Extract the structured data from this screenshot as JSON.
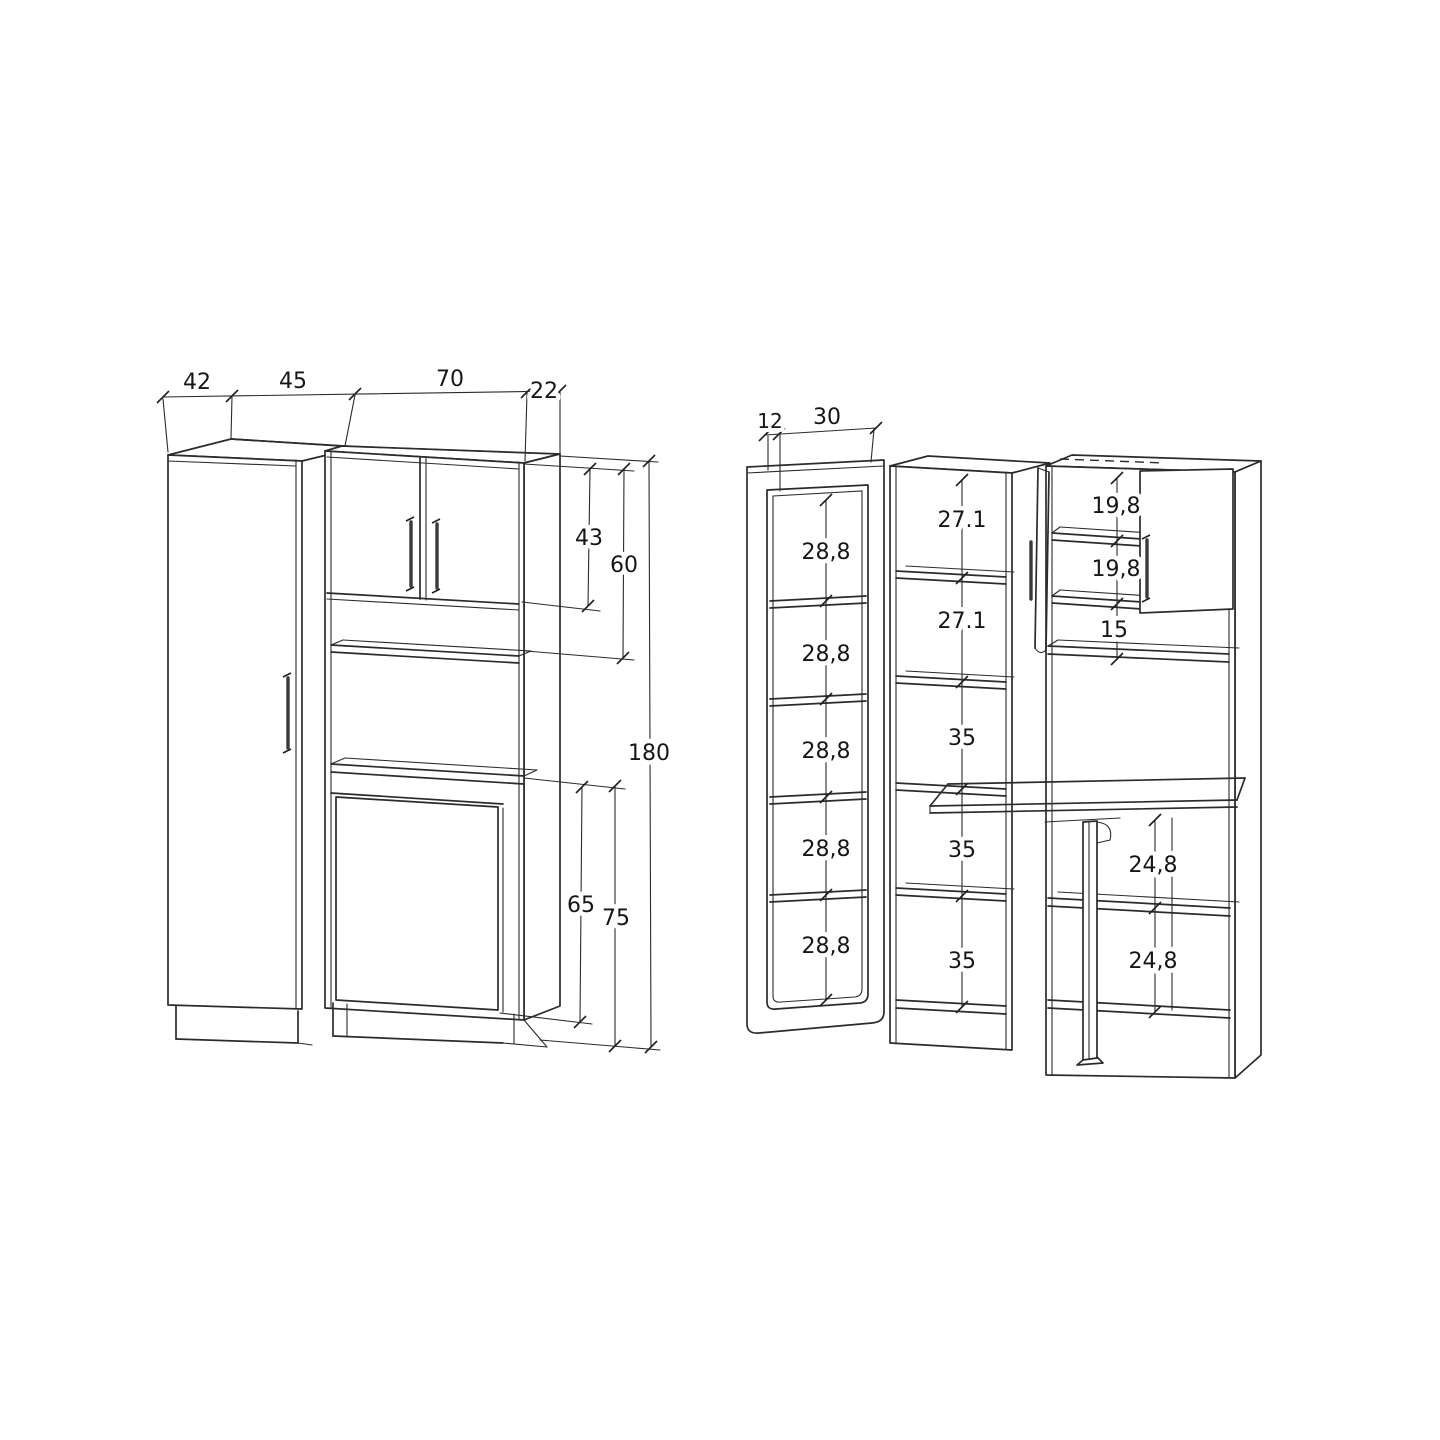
{
  "page": {
    "background": "#ffffff",
    "line_color": "#2b2b2b"
  },
  "left_view": {
    "top_widths": [
      "42",
      "45",
      "70",
      "22"
    ],
    "upper_door_height": "43",
    "upper_section_height": "60",
    "total_height": "180",
    "lower_door_height": "65",
    "lower_section_height": "75"
  },
  "right_view": {
    "depth": "12",
    "door_width": "30",
    "glass_door_cells": [
      "28,8",
      "28,8",
      "28,8",
      "28,8",
      "28,8"
    ],
    "tall_column_cells": [
      "27.1",
      "27.1",
      "35",
      "35",
      "35"
    ],
    "upper_shelf_gaps": [
      "19,8",
      "19,8",
      "15"
    ],
    "lower_shelf_gaps": [
      "24,8",
      "24,8"
    ]
  }
}
